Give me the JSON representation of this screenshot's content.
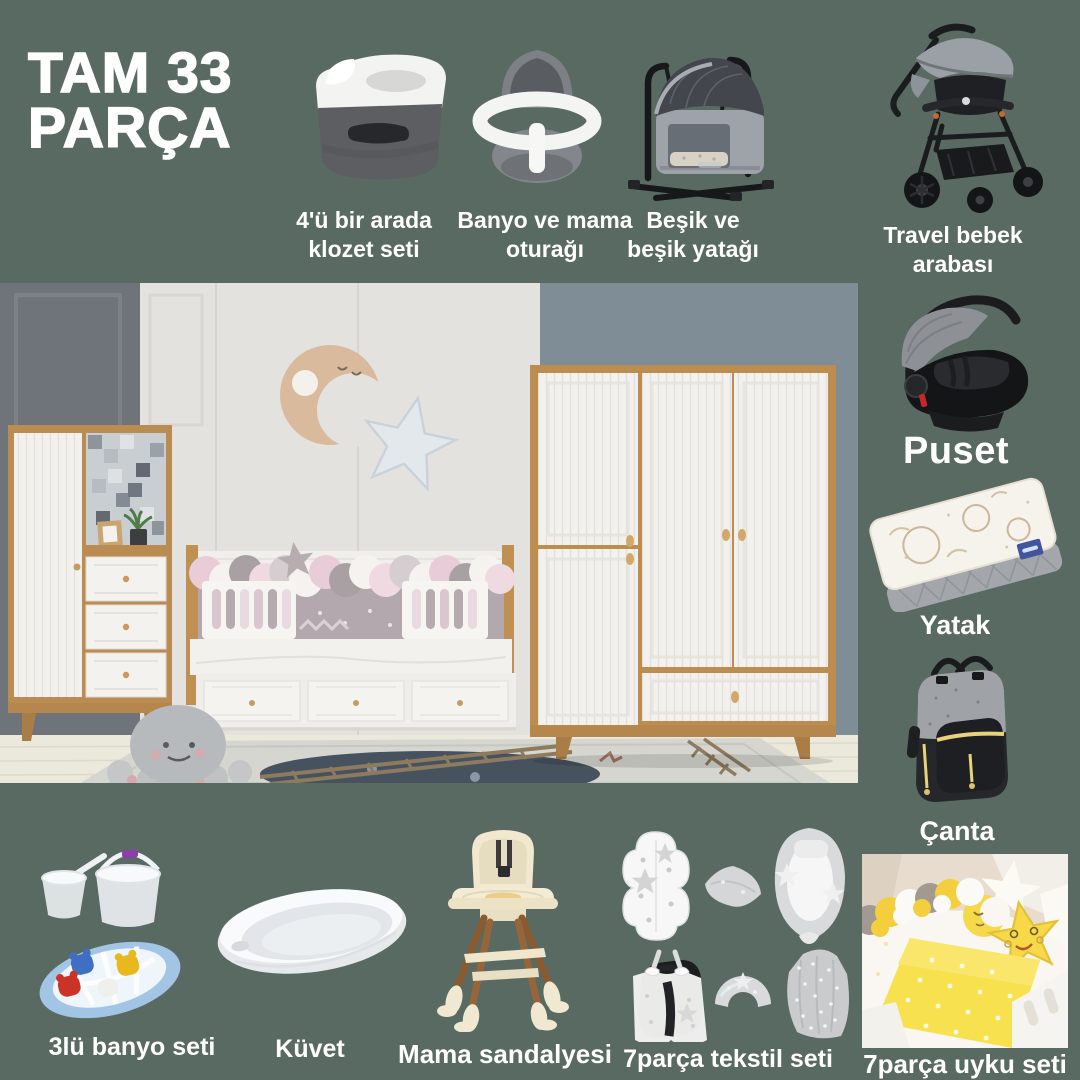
{
  "colors": {
    "background": "#596a63",
    "label_text": "#ffffff",
    "accent_yellow": "#f2d23c",
    "wood": "#bd8d4f",
    "wall_blue": "#7f8d96"
  },
  "title": {
    "line1": "TAM 33",
    "line2": "PARÇA"
  },
  "products": {
    "klozet": {
      "line1": "4'ü bir arada",
      "line2": "klozet seti"
    },
    "banyo_oturagi": {
      "line1": "Banyo ve mama",
      "line2": "oturağı"
    },
    "besik": {
      "line1": "Beşik ve",
      "line2": "beşik yatağı"
    },
    "travel_arabasi": {
      "line1": "Travel bebek",
      "line2": "arabası"
    },
    "puset": {
      "label": "Puset"
    },
    "yatak": {
      "label": "Yatak"
    },
    "canta": {
      "label": "Çanta"
    },
    "banyo_seti": {
      "label": "3lü banyo seti"
    },
    "kuvet": {
      "label": "Küvet"
    },
    "mama_sandalyesi": {
      "label": "Mama sandalyesi"
    },
    "tekstil_seti": {
      "label": "7parça tekstil seti"
    },
    "uyku_seti": {
      "label": "7parça uyku seti"
    }
  }
}
